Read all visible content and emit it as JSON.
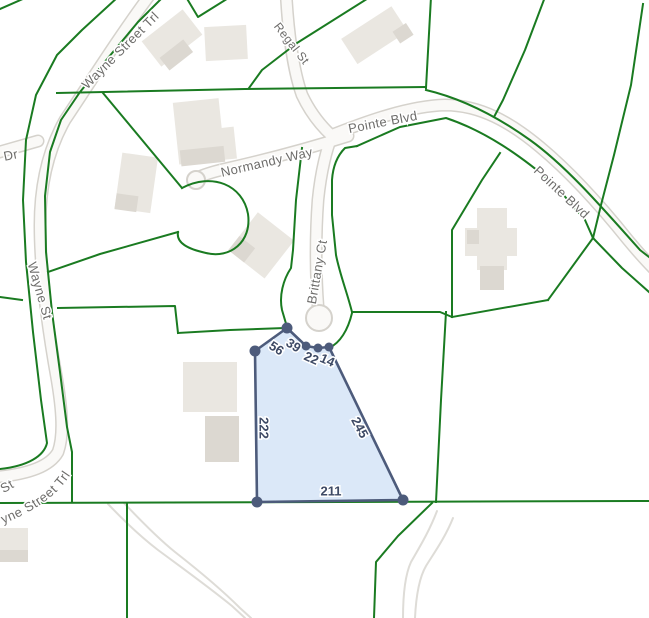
{
  "map": {
    "colors": {
      "background": "#ffffff",
      "parcel_line": "#1a7b21",
      "road_casing": "#d5d2cc",
      "road_fill": "#faf9f7",
      "building": "#eae7e1",
      "building_shade": "#dcd8d1",
      "trail": "#dedcd7",
      "street_label": "#6d6c6a",
      "highlight_fill": "#d2e2f6",
      "highlight_stroke": "#4d5b7b",
      "dimension_label": "#3e4a65"
    },
    "streets": [
      {
        "name": "Wayne Street Trl"
      },
      {
        "name": "Regal St"
      },
      {
        "name": "Pointe Blvd"
      },
      {
        "name": "Normandy Way"
      },
      {
        "name": "Pointe Blvd"
      },
      {
        "name": "Brittany Ct"
      },
      {
        "name": "Wayne St"
      },
      {
        "name": "Dr"
      },
      {
        "name": "t St"
      },
      {
        "name": "yne Street Trl"
      }
    ],
    "parcel": {
      "dimensions": {
        "top": [
          "56",
          "39",
          "22",
          "14"
        ],
        "left": "222",
        "right": "245",
        "bottom": "211"
      }
    }
  }
}
